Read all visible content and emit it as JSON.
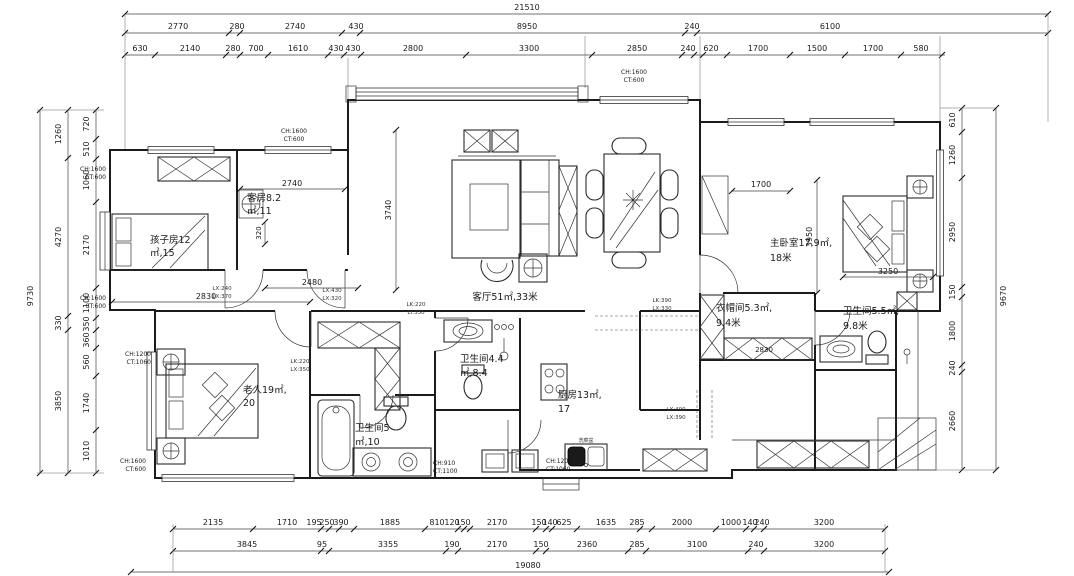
{
  "drawing": {
    "type": "apartment floor plan"
  },
  "dims": {
    "top1": [
      "21510"
    ],
    "top2": [
      "2770",
      "280",
      "2740",
      "430",
      "8950",
      "240",
      "6100"
    ],
    "top3": [
      "630",
      "2140",
      "280",
      "700",
      "1610",
      "430",
      "430",
      "2800",
      "3300",
      "2850",
      "240",
      "620",
      "1700",
      "1500",
      "1700",
      "580"
    ],
    "bottom1": [
      "2135",
      "1710",
      "195",
      "250",
      "390",
      "1885",
      "810",
      "120",
      "150",
      "2170",
      "150",
      "140",
      "625",
      "1635",
      "285",
      "2000",
      "1000",
      "140",
      "240",
      "3200"
    ],
    "bottom2": [
      "3845",
      "95",
      "3355",
      "190",
      "2170",
      "150",
      "2360",
      "285",
      "3100",
      "240",
      "3200"
    ],
    "bottom3": [
      "19080"
    ],
    "left_total": "9730",
    "left_mid": [
      "1260",
      "4270",
      "330",
      "3850"
    ],
    "left_inner": [
      "720",
      "510",
      "1060",
      "2170",
      "1100",
      "350",
      "360",
      "560",
      "1740",
      "1010"
    ],
    "right_total": "9670",
    "right_inner": [
      "610",
      "1260",
      "2950",
      "150",
      "1800",
      "240",
      "2660"
    ]
  },
  "interior_dims": {
    "guest_width": "2740",
    "hall_width": "2480",
    "elder_width": "2830",
    "niche": "320",
    "living_depth": "3740",
    "balcony": "1700",
    "master_depth": "3950",
    "master_width": "3250",
    "closet_width": "2830"
  },
  "rooms": {
    "living": "客厅51㎡,33米",
    "guest1": "客房8.2",
    "guest2": "㎡,11",
    "kids1": "孩子房12",
    "kids2": "㎡,15",
    "elder1": "老人19㎡,",
    "elder2": "20",
    "bath_a1": "卫生间4.4",
    "bath_a2": "㎡,8.4",
    "bath_b1": "卫生间5",
    "bath_b2": "㎡,10",
    "kitchen1": "厨房13㎡,",
    "kitchen2": "17",
    "master1": "主卧室17.9㎡,",
    "master2": "18米",
    "closet1": "衣帽间5.3㎡,",
    "closet2": "9.4米",
    "bath_c1": "卫生间5.5㎡,",
    "bath_c2": "9.8米"
  },
  "annotations": {
    "ch1600": "CH:1600",
    "ct600": "CT:600",
    "ch1200": "CH:1200",
    "ct1060": "CT:1060",
    "ch910": "CH:910",
    "ct1100": "CT:1100",
    "sink": "洗菜盆",
    "a1a": "LX:240",
    "a1b": "LX:370",
    "a2a": "LX:430",
    "a2b": "LX:320",
    "a3a": "LK:220",
    "a3b": "LY:330",
    "a4a": "LK:220",
    "a4b": "LX:350",
    "a5a": "LK:390",
    "a5b": "LX:330",
    "a6a": "LX:400",
    "a6b": "LX:390"
  }
}
